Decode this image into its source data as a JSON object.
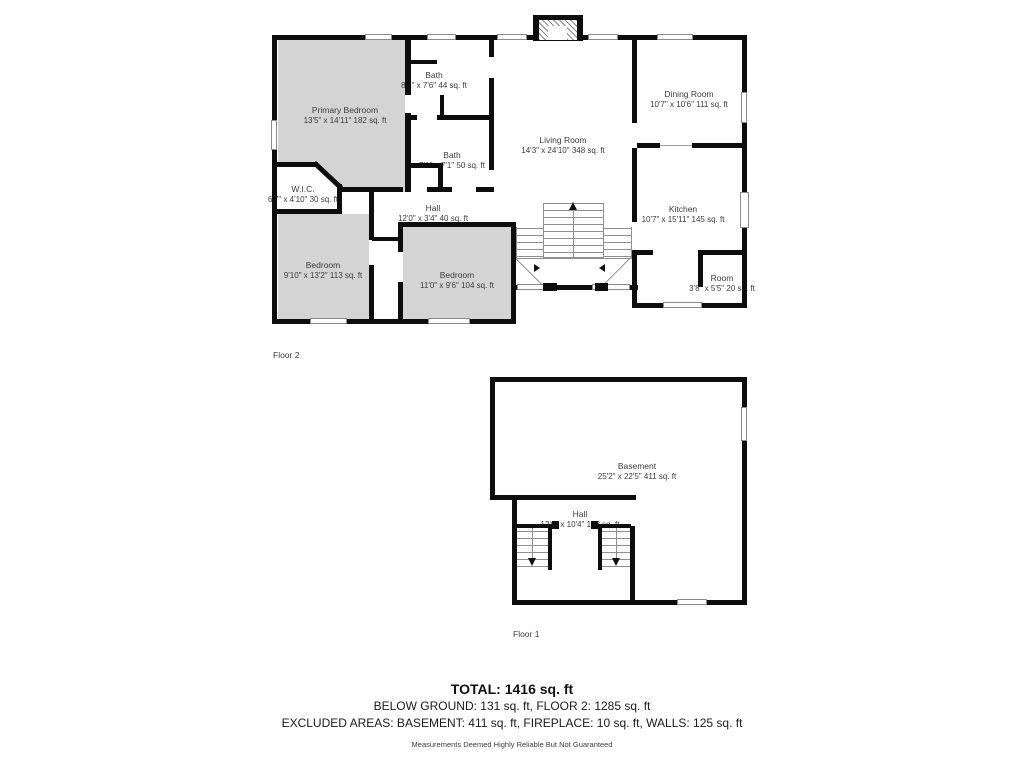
{
  "floor2": {
    "label": "Floor 2",
    "rooms": [
      {
        "name": "Primary Bedroom",
        "dims": "13'5\" x 14'11\" 182 sq. ft"
      },
      {
        "name": "Bath",
        "dims": "8'2\" x 7'6\" 44 sq. ft"
      },
      {
        "name": "Bath",
        "dims": "7'1\" x 7'1\" 50 sq. ft"
      },
      {
        "name": "W.I.C.",
        "dims": "6'7\" x 4'10\" 30 sq. ft"
      },
      {
        "name": "Hall",
        "dims": "12'0\" x 3'4\" 40 sq. ft"
      },
      {
        "name": "Bedroom",
        "dims": "9'10\" x 13'2\" 113 sq. ft"
      },
      {
        "name": "Bedroom",
        "dims": "11'0\" x 9'6\" 104 sq. ft"
      },
      {
        "name": "Living Room",
        "dims": "14'3\" x 24'10\" 348 sq. ft"
      },
      {
        "name": "Dining Room",
        "dims": "10'7\" x 10'6\" 111 sq. ft"
      },
      {
        "name": "Kitchen",
        "dims": "10'7\" x 15'11\" 145 sq. ft"
      },
      {
        "name": "Room",
        "dims": "3'8\" x 5'5\" 20 sq. ft"
      }
    ]
  },
  "floor1": {
    "label": "Floor 1",
    "rooms": [
      {
        "name": "Basement",
        "dims": "25'2\" x 22'5\" 411 sq. ft"
      },
      {
        "name": "Hall",
        "dims": "12'0\" x 10'4\" 123 sq. ft"
      }
    ]
  },
  "summary": {
    "total": "TOTAL: 1416 sq. ft",
    "below": "BELOW GROUND: 131 sq. ft, FLOOR 2: 1285 sq. ft",
    "excluded": "EXCLUDED AREAS: BASEMENT: 411 sq. ft, FIREPLACE: 10 sq. ft, WALLS: 125 sq. ft",
    "disclaimer": "Measurements Deemed Highly Reliable But Not Guaranteed"
  },
  "colors": {
    "wall": "#0d0d0d",
    "room_fill": "#d4d4d4",
    "label_text": "#3c3c3c"
  }
}
